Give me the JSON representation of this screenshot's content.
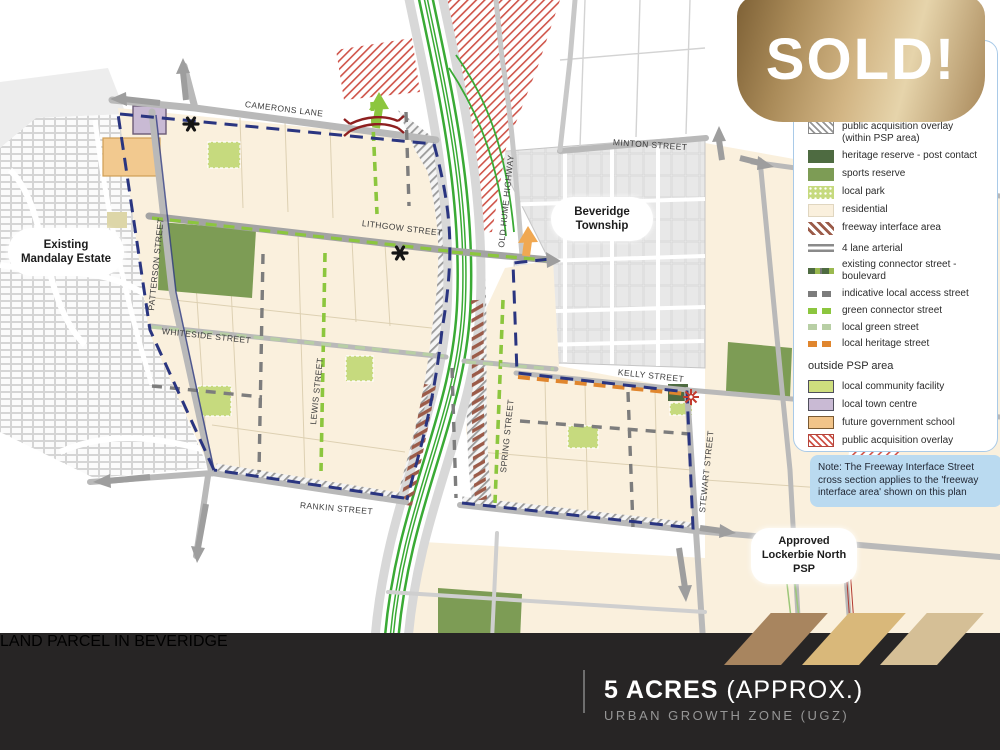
{
  "sold_badge": {
    "label": "SOLD!"
  },
  "legend": {
    "within_items": [
      {
        "icon": "hatch-gray-swatch",
        "label": "public acquisition overlay\n(within PSP area)"
      },
      {
        "icon": "heritage-reserve-swatch",
        "label": "heritage reserve - post contact"
      },
      {
        "icon": "sports-reserve-swatch",
        "label": "sports reserve"
      },
      {
        "icon": "local-park-swatch",
        "label": "local park"
      },
      {
        "icon": "residential-swatch",
        "label": "residential"
      },
      {
        "icon": "freeway-interface-swatch",
        "label": "freeway interface area"
      },
      {
        "icon": "four-lane-arterial-swatch",
        "label": "4 lane arterial"
      },
      {
        "icon": "boulevard-swatch",
        "label": "existing connector street - boulevard"
      },
      {
        "icon": "local-access-swatch",
        "label": "indicative local access street"
      },
      {
        "icon": "green-connector-swatch",
        "label": "green connector street"
      },
      {
        "icon": "local-green-swatch",
        "label": "local green street"
      },
      {
        "icon": "local-heritage-swatch",
        "label": "local heritage street"
      }
    ],
    "outside_header": "outside PSP area",
    "outside_items": [
      {
        "icon": "community-facility-swatch",
        "label": "local community facility"
      },
      {
        "icon": "town-centre-swatch",
        "label": "local town centre"
      },
      {
        "icon": "school-swatch",
        "label": "future government school"
      },
      {
        "icon": "acquisition-overlay-swatch",
        "label": "public acquisition overlay"
      }
    ]
  },
  "note": {
    "text": "Note: The Freeway Interface Street cross section applies to the 'freeway interface area' shown on this plan"
  },
  "map": {
    "area_labels": [
      {
        "text": "Existing\nMandalay Estate"
      },
      {
        "text": "Beveridge\nTownship"
      },
      {
        "text": "Approved\nLockerbie North\nPSP"
      }
    ],
    "streets": [
      {
        "name": "CAMERONS LANE"
      },
      {
        "name": "MINTON STREET"
      },
      {
        "name": "OLD HUME HIGHWAY"
      },
      {
        "name": "LITHGOW STREET"
      },
      {
        "name": "PATTERSON STREET"
      },
      {
        "name": "WHITESIDE STREET"
      },
      {
        "name": "LEWIS STREET"
      },
      {
        "name": "SPRING STREET"
      },
      {
        "name": "KELLY STREET"
      },
      {
        "name": "STEWART STREET"
      },
      {
        "name": "RANKIN STREET"
      }
    ]
  },
  "banner": {
    "title": "LAND PARCEL IN BEVERIDGE",
    "acres": "5 ACRES",
    "acres_suffix": " (APPROX.)",
    "subtitle": "URBAN GROWTH ZONE (UGZ)"
  },
  "colors": {
    "gold_dark": "#7e6136",
    "gold_light": "#e6d4ab",
    "banner_bg": "#272525",
    "residential": "#faf0dd",
    "sports_reserve": "#7d9c55",
    "heritage_reserve": "#4e6b41",
    "green_connector": "#8cc63e",
    "local_green_street": "#b8cfa5",
    "local_heritage_street": "#e0862e",
    "psp_boundary_blue": "#2a3580",
    "note_bg": "#badaf0",
    "freeway_green": "#3aaa35"
  }
}
